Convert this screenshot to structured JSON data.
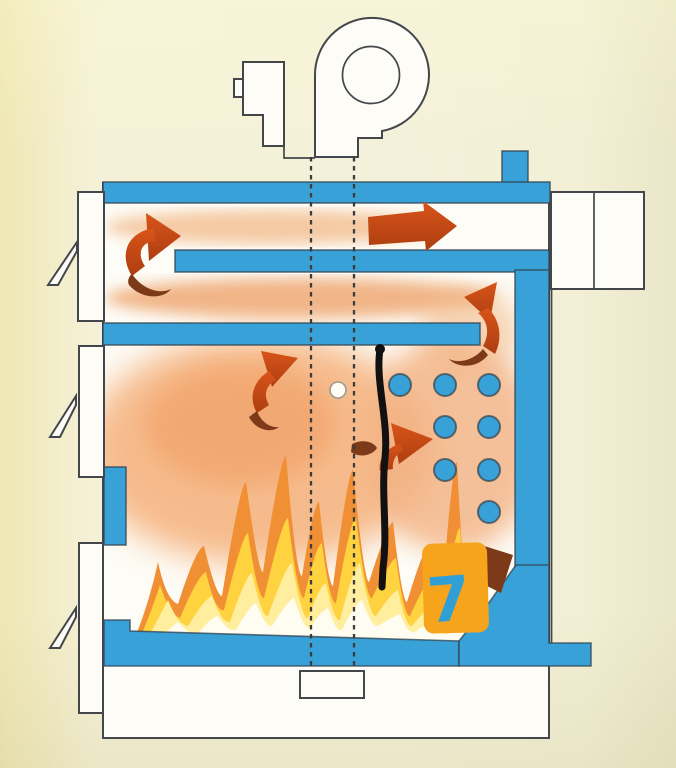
{
  "meta": {
    "title": "Solid-fuel heating boiler cross-section with flue-gas flow",
    "kind": "technical-illustration",
    "contains_text": false
  },
  "palette": {
    "background_cream": "#f4f1da",
    "background_yellow_edge": "#efe7b4",
    "water_blue": "#38a1d8",
    "outline_dark": "#43464a",
    "arrow_red": "#cc4a16",
    "arrow_dark_tail": "#7c3a18",
    "flame_orange": "#f08f33",
    "flame_yellow": "#ffd23f",
    "flame_pale": "#ffee9e",
    "glow_orange": "#f5b07a",
    "marker_orange": "#f7a41d",
    "marker_blue": "#2f9fd6",
    "annotation_black": "#111111"
  },
  "components": {
    "fan": {
      "name": "centrifugal flue fan on top of boiler",
      "style": "outline drawing",
      "parts": [
        "spiral housing",
        "inlet circle",
        "motor block"
      ]
    },
    "chimney_stub": {
      "name": "water-jacket stub on top plate"
    },
    "flue_outlet_box": {
      "name": "flue outlet duct at top right",
      "panes": 2
    },
    "water_jacket_segments": [
      "top plate",
      "middle baffle",
      "lower baffle",
      "right wall",
      "left wall segment",
      "grate / floor",
      "bottom-right outlet foot"
    ],
    "doors": [
      {
        "name": "upper cleaning door",
        "handle": "wedge latch"
      },
      {
        "name": "fuel loading door",
        "handle": "wedge latch"
      },
      {
        "name": "ash door",
        "handle": "wedge latch"
      }
    ],
    "tube_holes": {
      "description": "fire-tube openings in rear heat-exchange wall",
      "radius": 11,
      "count": 8,
      "rows": [
        {
          "y": 385,
          "x": [
            400,
            445,
            489
          ]
        },
        {
          "y": 427,
          "x": [
            445,
            489
          ]
        },
        {
          "y": 470,
          "x": [
            445,
            489
          ]
        },
        {
          "y": 512,
          "x": [
            489
          ]
        }
      ]
    },
    "axis_lines": {
      "description": "dashed burner axis lines from fan to burner port",
      "x": [
        311,
        354
      ],
      "from_y": 157,
      "to_y": 671
    },
    "burner_port": {
      "name": "small rectangular port at bottom centre"
    },
    "secondary_air_hole": {
      "name": "small white hole in combustion chamber",
      "cx": 338,
      "cy": 390
    },
    "flames": {
      "name": "fire on grate in combustion chamber",
      "colors": [
        "#f08f33",
        "#ffd23f",
        "#ffee9e",
        "#fffdf2"
      ]
    },
    "flow_arrows": [
      {
        "id": "u-turn-left-top",
        "direction": "up and right around left end of middle baffle"
      },
      {
        "id": "top-channel-exit",
        "direction": "right toward flue outlet"
      },
      {
        "id": "right-baffle-turn",
        "direction": "up and left around right end of lower baffle"
      },
      {
        "id": "chamber-rise",
        "direction": "up-right inside combustion chamber"
      },
      {
        "id": "toward-tubes",
        "direction": "up-right toward fire tubes"
      },
      {
        "id": "bottom-right-down",
        "direction": "down-right behind marker highlight"
      }
    ]
  },
  "annotations": {
    "digit": "7",
    "digit_color": "#2f9fd6",
    "highlight": {
      "shape": "orange marker block",
      "color": "#f7a41d"
    },
    "hand_line": {
      "description": "black hand-drawn vertical line from baffle down into flames",
      "color": "#111111"
    }
  }
}
